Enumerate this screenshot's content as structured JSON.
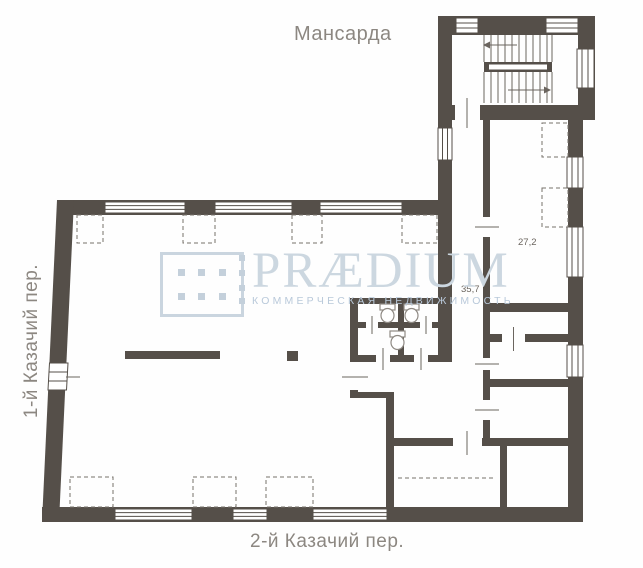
{
  "title": "Мансарда",
  "streets": {
    "left": "1-й Казачий пер.",
    "bottom": "2-й Казачий пер."
  },
  "rooms": [
    {
      "id": "room-27",
      "area_label": "27,2"
    },
    {
      "id": "hall-35",
      "area_label": "35,7"
    }
  ],
  "watermark": {
    "brand": "PRÆDIUM",
    "subtitle": "КОММЕРЧЕСКАЯ НЕДВИЖИМОСТЬ"
  },
  "colors": {
    "wall": "#554f49",
    "line": "#6b655f",
    "label_text": "#8c8781",
    "watermark_primary": "#ccd7e0",
    "watermark_secondary": "#b9c9da"
  }
}
